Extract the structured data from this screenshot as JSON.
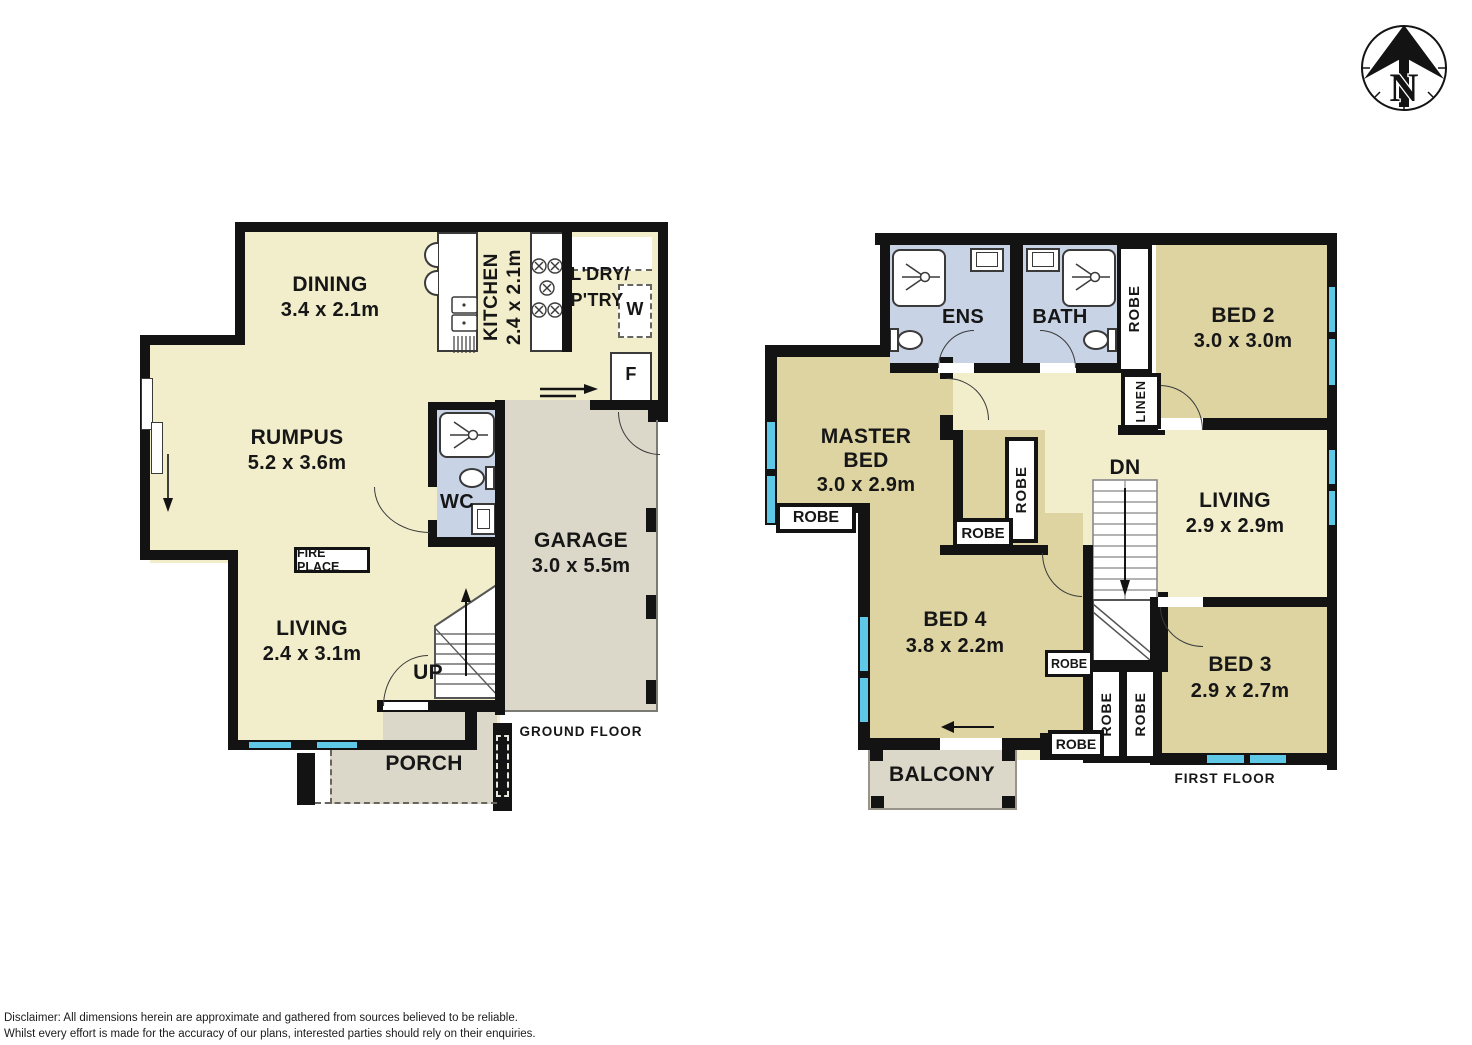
{
  "colors": {
    "wall": "#131313",
    "cream": "#f2eecc",
    "tan": "#ddd4a2",
    "bath_blue": "#c8d3e6",
    "garage_gray": "#dbd7c9",
    "window_cyan": "#5ec8e6"
  },
  "compass": {
    "label": "N"
  },
  "disclaimer": {
    "line1": "Disclaimer: All dimensions herein are approximate and gathered from sources believed to be reliable.",
    "line2": "Whilst every effort is made for the accuracy of our plans, interested parties should rely on their enquiries."
  },
  "ground_floor": {
    "floor_label": "GROUND FLOOR",
    "dining": {
      "name": "DINING",
      "dims": "3.4 x 2.1m"
    },
    "kitchen": {
      "name": "KITCHEN",
      "dims": "2.4 x 2.1m"
    },
    "laundry": {
      "line1": "L'DRY/",
      "line2": "P'TRY"
    },
    "washer": "W",
    "fridge": "F",
    "rumpus": {
      "name": "RUMPUS",
      "dims": "5.2 x 3.6m"
    },
    "wc": {
      "name": "WC"
    },
    "fireplace": "FIRE PLACE",
    "living": {
      "name": "LIVING",
      "dims": "2.4 x 3.1m"
    },
    "up": "UP",
    "garage": {
      "name": "GARAGE",
      "dims": "3.0 x 5.5m"
    },
    "porch": {
      "name": "PORCH"
    }
  },
  "first_floor": {
    "floor_label": "FIRST FLOOR",
    "ens": {
      "name": "ENS"
    },
    "bath": {
      "name": "BATH"
    },
    "bed2": {
      "name": "BED 2",
      "dims": "3.0 x 3.0m"
    },
    "master": {
      "line1": "MASTER",
      "line2": "BED",
      "dims": "3.0 x 2.9m"
    },
    "living": {
      "name": "LIVING",
      "dims": "2.9 x 2.9m"
    },
    "bed4": {
      "name": "BED 4",
      "dims": "3.8 x 2.2m"
    },
    "bed3": {
      "name": "BED 3",
      "dims": "2.9 x 2.7m"
    },
    "balcony": {
      "name": "BALCONY"
    },
    "robe": "ROBE",
    "linen": "LINEN",
    "dn": "DN"
  }
}
